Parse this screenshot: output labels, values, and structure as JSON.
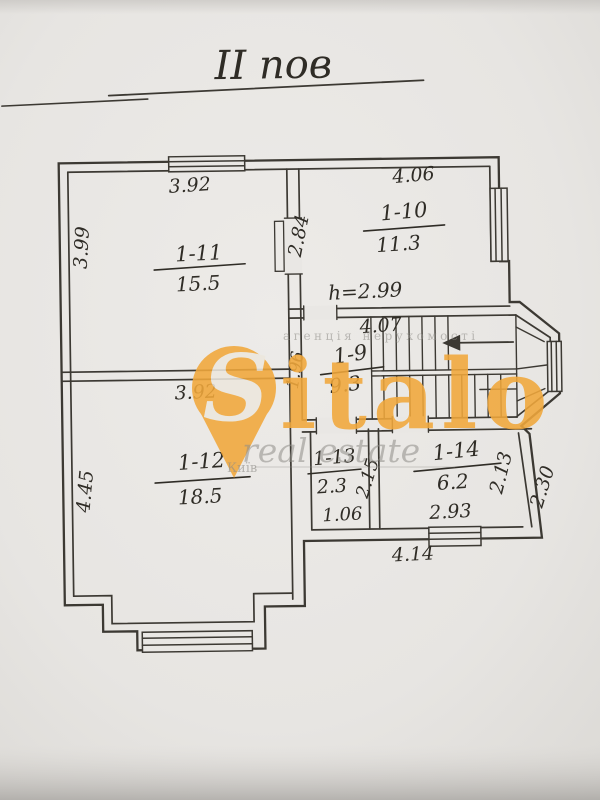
{
  "photo": {
    "title": "II пов",
    "rooms": [
      {
        "id": "1-11",
        "area": "15.5"
      },
      {
        "id": "1-10",
        "area": "11.3"
      },
      {
        "id": "1-9",
        "area": "9.3"
      },
      {
        "id": "1-12",
        "area": "18.5"
      },
      {
        "id": "1-13",
        "area": "2.3"
      },
      {
        "id": "1-14",
        "area": "6.2"
      }
    ],
    "dims": {
      "r11_w": "3.92",
      "r11_h": "3.99",
      "r10_w": "4.06",
      "r10_h": "2.84",
      "ceiling": "h=2.99",
      "hall_w": "4.07",
      "hall_h": "1.96",
      "r12_w": "3.92",
      "r12_h": "4.45",
      "r13_w": "1.06",
      "r13_h": "2.15",
      "r14_w": "2.93",
      "r14_h": "2.13",
      "right_side": "2.30",
      "bottom_w": "4.14"
    }
  },
  "watermark": {
    "pin_letter": "S",
    "wordmark": "italo",
    "tagline": "real estate",
    "agency": "агенція нерухомості",
    "city": "Київ",
    "orange": "#F1A83B",
    "gray": "#8F8D88"
  }
}
